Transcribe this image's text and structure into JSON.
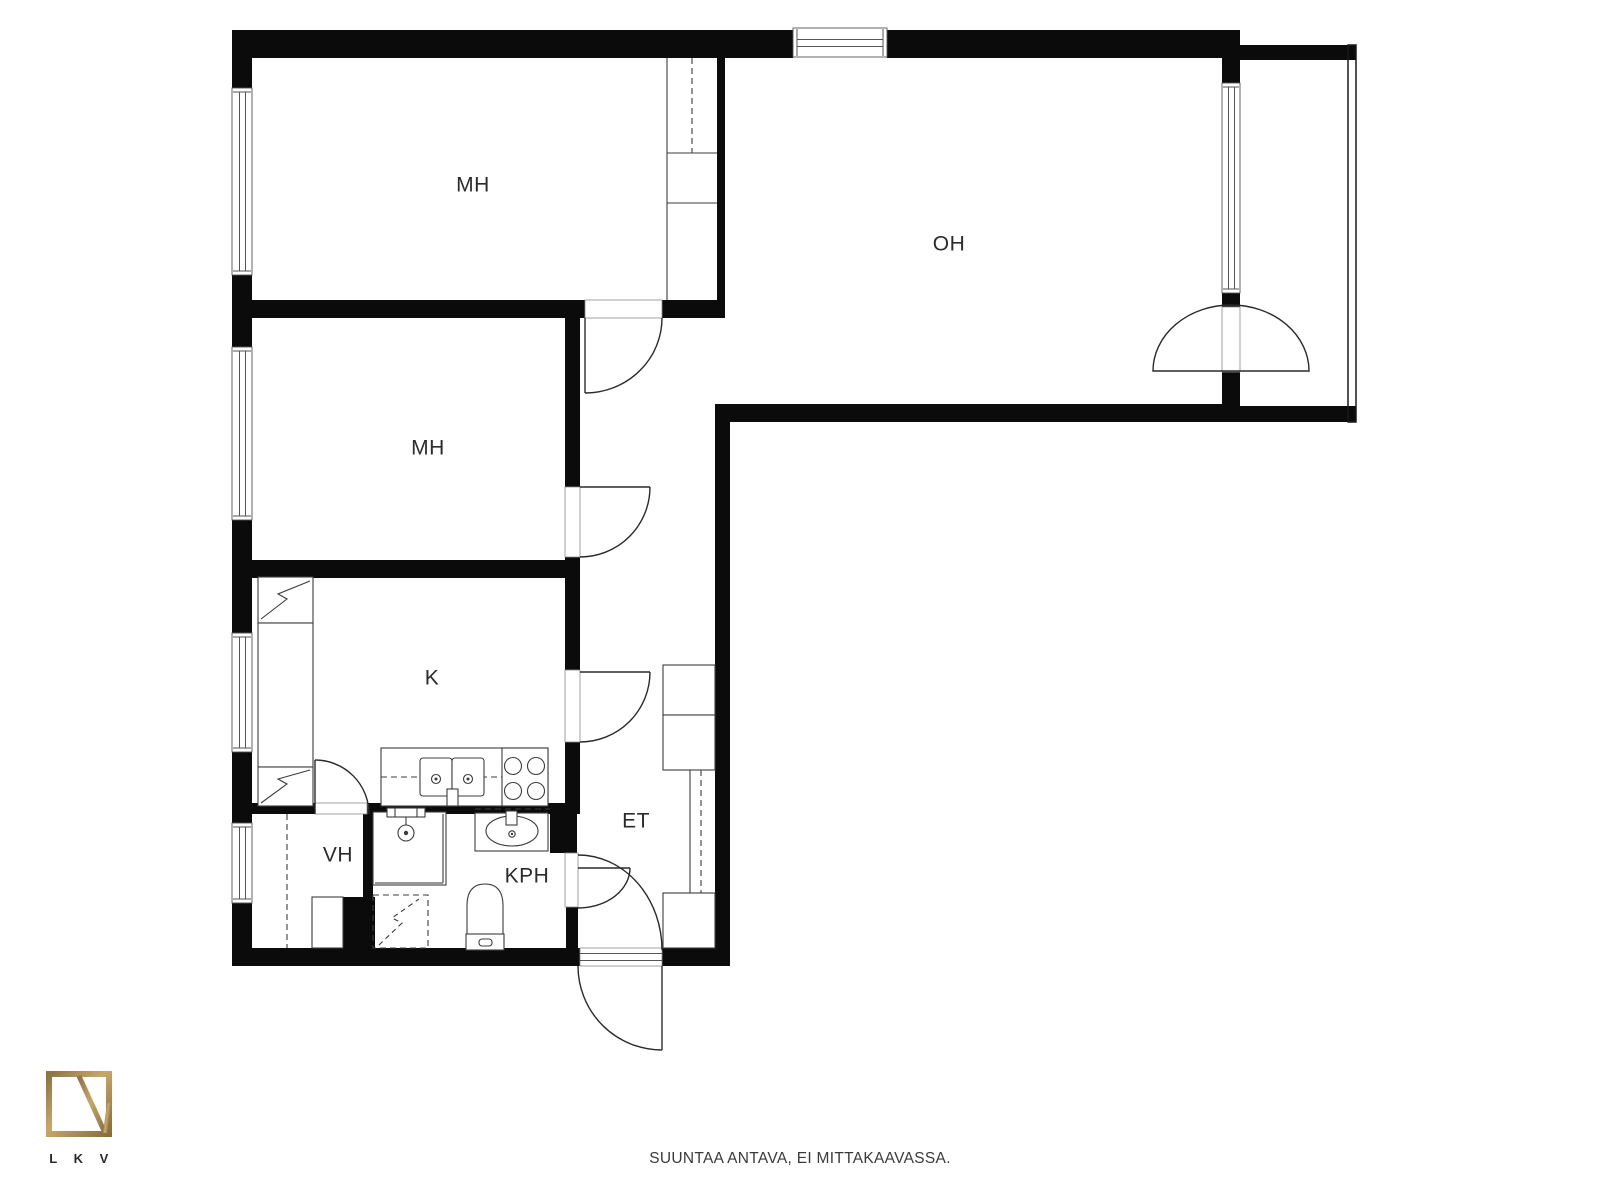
{
  "plan": {
    "type": "apartment-floor-plan",
    "rooms": [
      {
        "id": "bedroom-1",
        "label": "MH"
      },
      {
        "id": "bedroom-2",
        "label": "MH"
      },
      {
        "id": "living-room",
        "label": "OH"
      },
      {
        "id": "kitchen",
        "label": "K"
      },
      {
        "id": "entry-hall",
        "label": "ET"
      },
      {
        "id": "closet",
        "label": "VH"
      },
      {
        "id": "bathroom",
        "label": "KPH"
      }
    ]
  },
  "footer": {
    "disclaimer": "SUUNTAA ANTAVA, EI MITTAKAAVASSA.",
    "logo_caption": "L K V"
  },
  "colors": {
    "background": "#ffffff",
    "wall": "#0b0b0b",
    "fixture_line": "#3c3c3c",
    "label_text": "#2b2b2b",
    "footer_text": "#3a3a3a",
    "logo_gold": "#a8864f"
  }
}
